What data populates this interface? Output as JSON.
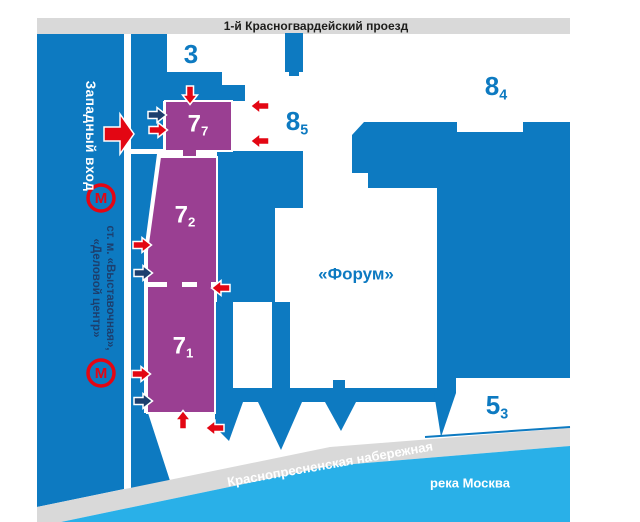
{
  "colors": {
    "blue": "#0d7ac1",
    "light_blue": "#29b0e8",
    "purple": "#9a3f92",
    "red": "#e30613",
    "navy": "#1c3f6e",
    "gray": "#d9d9d9",
    "text_dark": "#1d1d1b"
  },
  "streets": {
    "top": "1-й Красногвардейский проезд",
    "embankment": "Краснопресненская набережная",
    "river": "река Москва"
  },
  "west_entrance": {
    "label": "Западный вход"
  },
  "metro": {
    "icon_letter": "М",
    "line1": "ст. м. «Выставочная»,",
    "line2": "«Деловой центр»"
  },
  "pavilions": {
    "p3": {
      "main": "3",
      "sub": ""
    },
    "p77": {
      "main": "7",
      "sub": "7"
    },
    "p72": {
      "main": "7",
      "sub": "2"
    },
    "p71": {
      "main": "7",
      "sub": "1"
    },
    "p85": {
      "main": "8",
      "sub": "5"
    },
    "p84": {
      "main": "8",
      "sub": "4"
    },
    "p53": {
      "main": "5",
      "sub": "3"
    },
    "forum": {
      "label": "«Форум»"
    }
  },
  "arrows": [
    {
      "dir": "down",
      "color": "red",
      "x": 190,
      "y": 95
    },
    {
      "dir": "right",
      "color": "navy",
      "x": 157,
      "y": 115
    },
    {
      "dir": "right",
      "color": "red",
      "x": 158,
      "y": 130
    },
    {
      "dir": "left",
      "color": "red",
      "x": 260,
      "y": 106
    },
    {
      "dir": "left",
      "color": "red",
      "x": 260,
      "y": 141
    },
    {
      "dir": "right",
      "color": "red",
      "x": 142,
      "y": 245
    },
    {
      "dir": "right",
      "color": "navy",
      "x": 143,
      "y": 273
    },
    {
      "dir": "left",
      "color": "red",
      "x": 221,
      "y": 288
    },
    {
      "dir": "right",
      "color": "red",
      "x": 141,
      "y": 374
    },
    {
      "dir": "right",
      "color": "navy",
      "x": 143,
      "y": 401
    },
    {
      "dir": "up",
      "color": "red",
      "x": 183,
      "y": 420
    },
    {
      "dir": "left",
      "color": "red",
      "x": 215,
      "y": 428
    }
  ]
}
